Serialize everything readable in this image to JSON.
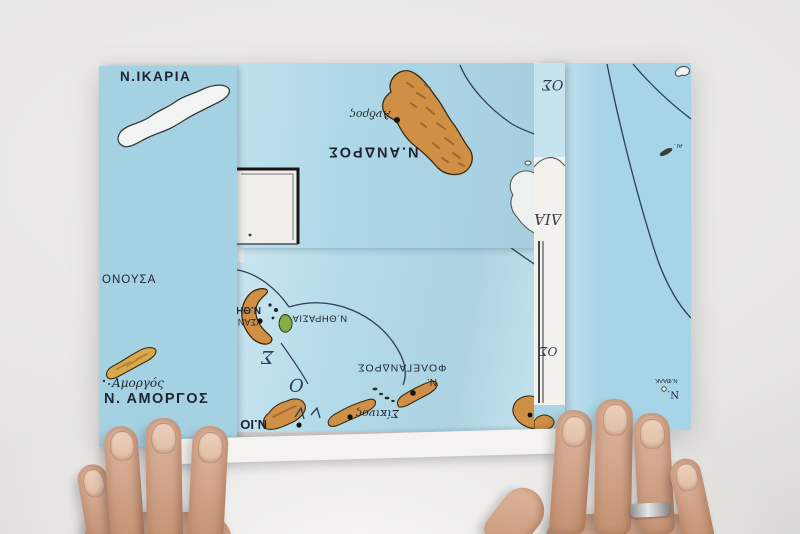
{
  "scene": {
    "title": "Folded paper map of Greek Aegean islands on a light table, touched by two hands",
    "type": "photograph",
    "surface": "light gray studio tabletop",
    "hands": [
      "left hand, four fingers touching lower map edge",
      "right hand with silver ring touching lower map edge"
    ]
  },
  "map": {
    "region": "Cyclades islands, Aegean Sea — school wall map, folded with some panels upside-down",
    "colors": {
      "sea": "#a9d4e5",
      "sea_light": "#b3dbe9",
      "land_orange": "#cf8f45",
      "land_shading": "#7a4a1e",
      "uncolored_island": "#f1f4f3",
      "paper_margin": "#f3f2ee",
      "route_line": "#2e3d58",
      "label_ink": "#1d2430",
      "volcanic_green": "#87ab49",
      "ring_silver": "#c9c9c9"
    },
    "labels": {
      "ikaria": "Ν.ΙΚΑΡΙΑ",
      "donousa": "ΟΝΟΥΣΑ",
      "amorgos_town": "Αμοργός",
      "amorgos": "Ν. ΑΜΟΡΓΟΣ",
      "andros_town": "Άνδρος",
      "andros": "Ν.ΑΝΔΡΟΣ",
      "thira_frag": "Ν.ΘΗ",
      "santorini_frag": "(ΣΑΝ",
      "thirasia": "Ν.ΘΗΡΑΣΙΑ",
      "folegandros": "ΦΟΛΕΓΑΝΔΡΟΣ",
      "folegandros_prefix": "Ν.",
      "sikinos_town": "Σίκινος",
      "ios_frag": "Ν.ΙΟ",
      "sea_letter_sigma": "Σ",
      "sea_letter_omicron": "Ο",
      "sea_frag_top": "ΟΣ",
      "sea_frag_dia": "ΔΙΑ",
      "sea_frag_mid": "ΟΣ",
      "ag_islet": "ΑΓ.",
      "falkonera_frag": "Ν.ΦΑΛΚ",
      "n_frag": "Ν."
    }
  }
}
